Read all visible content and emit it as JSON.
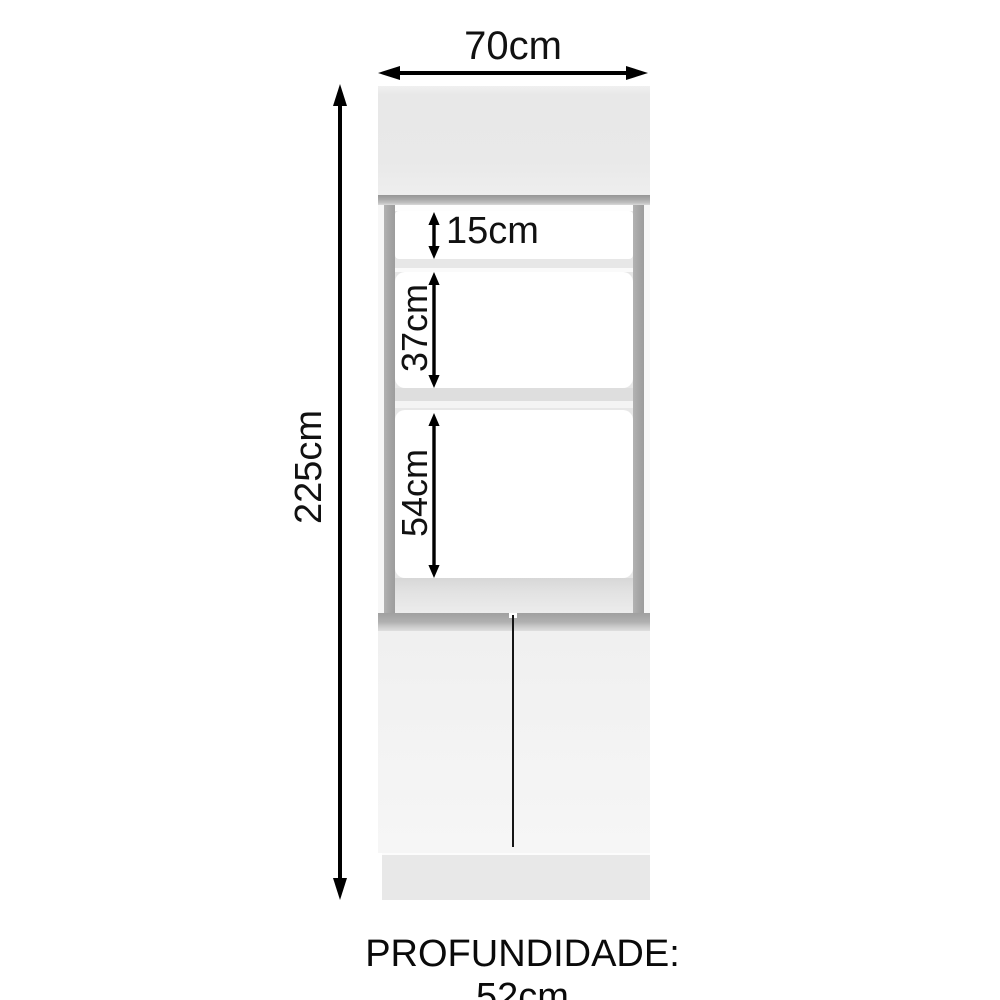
{
  "diagram": {
    "subject": "cabinet-dimension-diagram",
    "labels": {
      "width": "70cm",
      "height": "225cm",
      "niche_top": "15cm",
      "niche_middle": "37cm",
      "niche_bottom": "54cm",
      "depth": "PROFUNDIDADE: 52cm"
    },
    "colors": {
      "background": "#ffffff",
      "arrow": "#000000",
      "text": "#111111",
      "door_panel": "#ebebeb",
      "trim_gray": "#a8a8a8",
      "niche_frame_gray": "#e7e7e7",
      "niche_column_gray": "#a4a4a4",
      "niche_interior": "#ffffff",
      "lower_doors": "#f3f3f3",
      "plinth": "#e8e8e8",
      "door_divider": "#151515"
    }
  }
}
